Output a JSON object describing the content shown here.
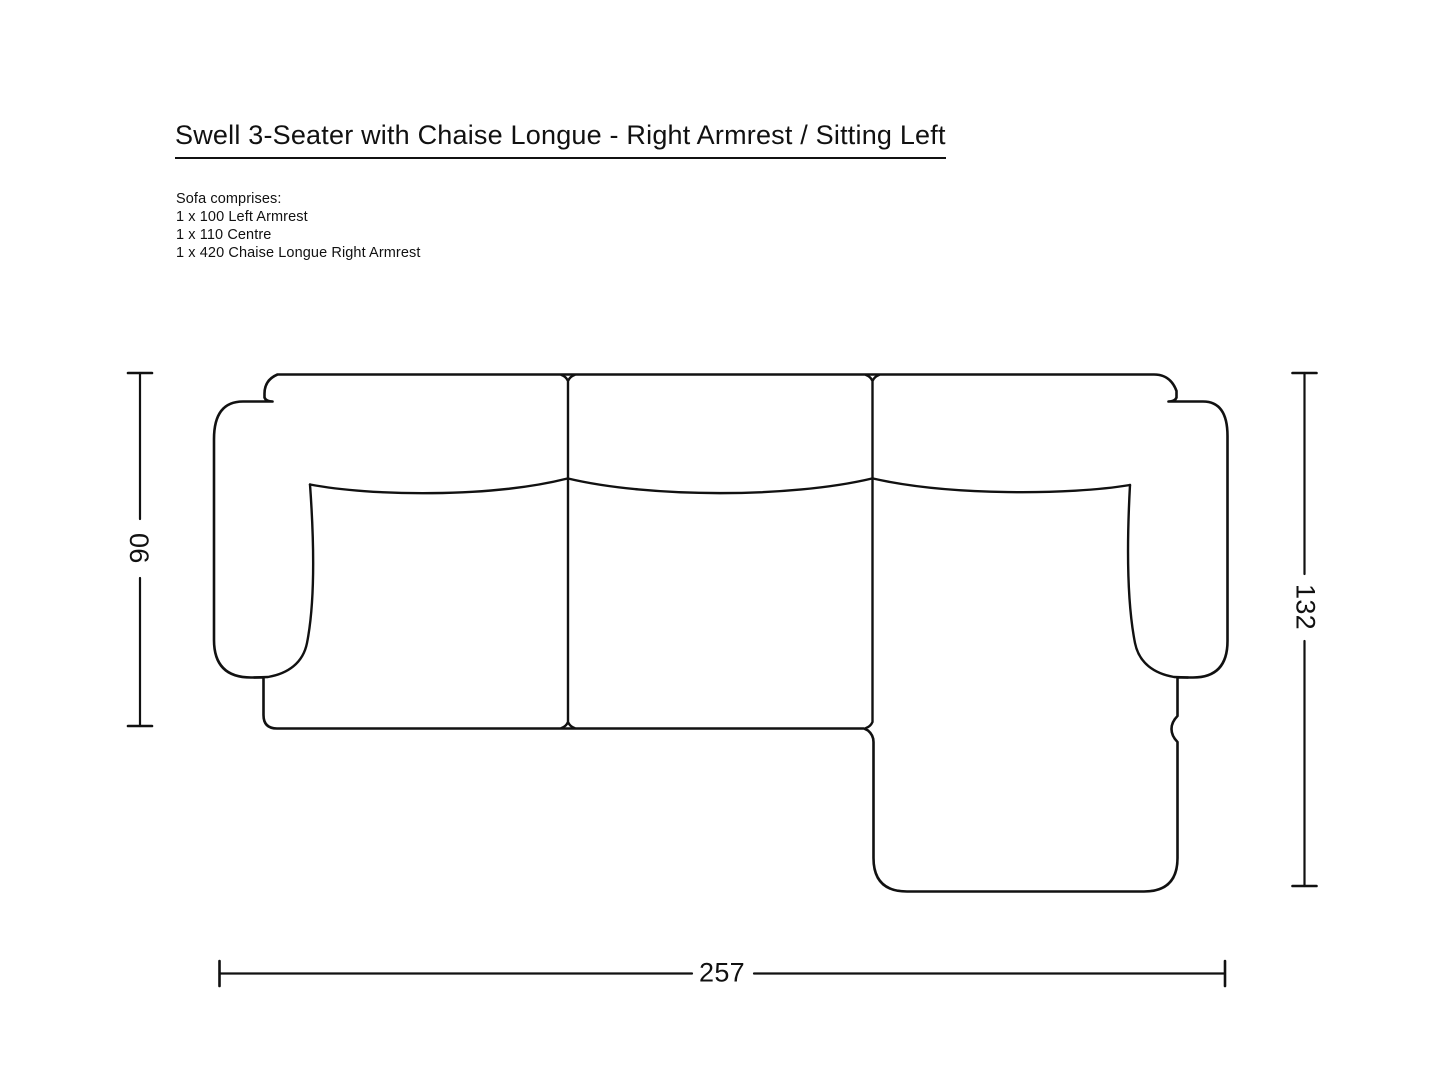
{
  "page": {
    "background_color": "#ffffff",
    "line_color": "#111111",
    "text_color": "#111111"
  },
  "title": "Swell 3-Seater with Chaise Longue - Right Armrest / Sitting Left",
  "comprises": {
    "heading": "Sofa comprises:",
    "items": [
      "1 x 100 Left Armrest",
      "1 x 110 Centre",
      "1 x 420 Chaise Longue Right Armrest"
    ]
  },
  "dimensions": {
    "depth_left": "90",
    "depth_right": "132",
    "width_bottom": "257"
  }
}
